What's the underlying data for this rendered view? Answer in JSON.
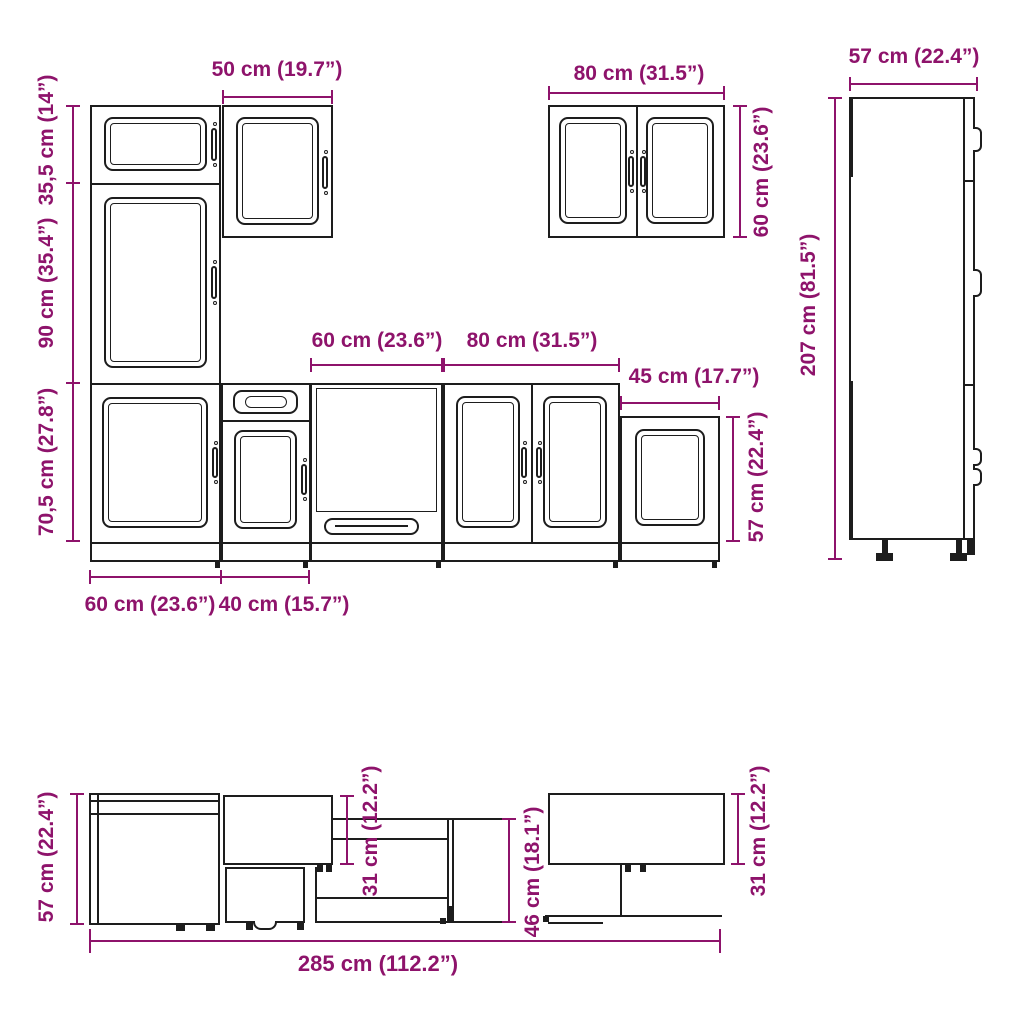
{
  "colors": {
    "accent": "#8e136b",
    "ink": "#1d1d1d",
    "background": "#ffffff"
  },
  "front": {
    "w50": "50 cm (19.7”)",
    "h355": "35,5 cm (14”)",
    "h90": "90 cm (35.4”)",
    "h705": "70,5 cm (27.8”)",
    "w60_left": "60 cm (23.6”)",
    "w40": "40 cm (15.7”)",
    "w60_mid": "60 cm (23.6”)",
    "w80_base": "80 cm (31.5”)",
    "w45": "45 cm (17.7”)",
    "h57_base": "57 cm (22.4”)",
    "w80_wall": "80 cm (31.5”)",
    "h60_wall": "60 cm (23.6”)",
    "w57_tall": "57 cm (22.4”)",
    "h207": "207 cm (81.5”)"
  },
  "plan": {
    "d57": "57 cm (22.4”)",
    "d31_mid": "31 cm (12.2”)",
    "d46": "46 cm (18.1”)",
    "d31_right": "31 cm (12.2”)",
    "w285": "285 cm (112.2”)"
  }
}
